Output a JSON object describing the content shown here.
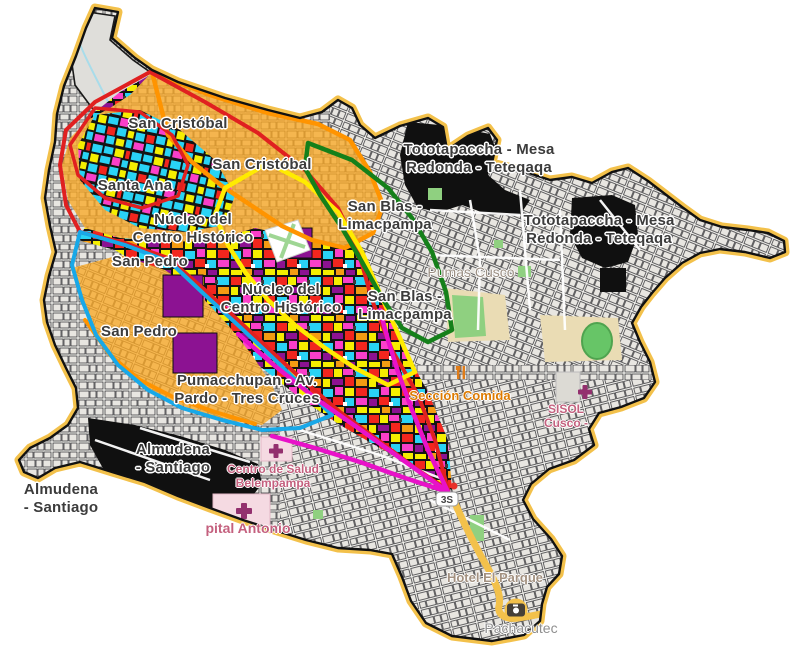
{
  "zone_labels": [
    {
      "line1": "San Cristóbal"
    },
    {
      "line1": "San Cristóbal"
    },
    {
      "line1": "Santa Ana"
    },
    {
      "line1": "Núcleo del",
      "line2": "Centro Histórico"
    },
    {
      "line1": "Núcleo del",
      "line2": "Centro Histórico"
    },
    {
      "line1": "San Pedro"
    },
    {
      "line1": "San Pedro"
    },
    {
      "line1": "San Blas -",
      "line2": "Limacpampa"
    },
    {
      "line1": "San Blas -",
      "line2": "Limacpampa"
    },
    {
      "line1": "Tototapaccha - Mesa",
      "line2": "Redonda - Teteqaqa"
    },
    {
      "line1": "Tototapaccha - Mesa",
      "line2": "Redonda - Teteqaqa"
    },
    {
      "line1": "Pumacchupan - Av.",
      "line2": "Pardo - Tres Cruces"
    },
    {
      "line1": "Almudena",
      "line2": "- Santiago"
    },
    {
      "line1": "Almudena",
      "line2": "- Santiago"
    }
  ],
  "poi_labels": {
    "pumas_cusco": "Pumas Cusco",
    "seccion_comida": "Sección Comida",
    "sisol_line1": "SISOL",
    "sisol_line2": "Cusco -",
    "salud_line1": "Centro de Salud",
    "salud_line2": "Belempampa",
    "hospital_antonio": "pital Antonio",
    "hotel_el_parque": "Hotel El Parque",
    "pachacutec": "Pachacutec"
  },
  "road_shield": "3S",
  "icons": [
    "hospital-cross-icon",
    "restaurant-icon",
    "camera-icon",
    "route-shield"
  ],
  "colors": {
    "boundary_red": "#E02020",
    "boundary_cyan": "#18A8E8",
    "boundary_yellow": "#FFEB00",
    "boundary_green": "#15801A",
    "boundary_orange": "#FF9400",
    "boundary_magenta": "#E812C8",
    "district_casing": "#F3C14B",
    "orange_zone": "#F9A826",
    "black_zone": "#101010",
    "park_green": "#8FD080",
    "campus_tan": "#EADCB4",
    "hospital_pink": "#F5DAE2",
    "hospital_icon": "#93306E",
    "road_yellow": "#F3C14B"
  }
}
